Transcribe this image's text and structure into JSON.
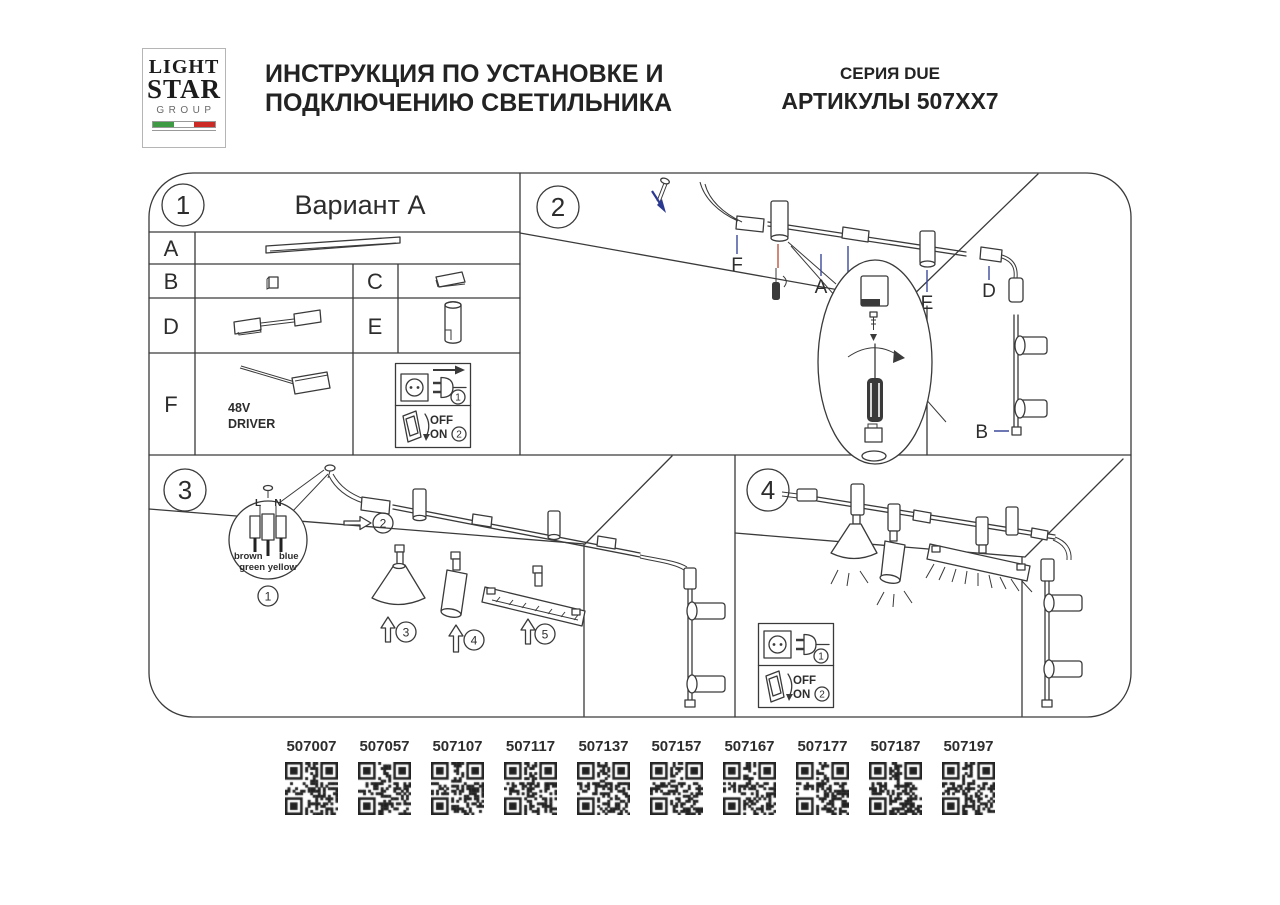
{
  "header": {
    "logo_line1": "LIGHT",
    "logo_line2": "STAR",
    "logo_line3": "GROUP",
    "title_line1": "ИНСТРУКЦИЯ ПО УСТАНОВКЕ И",
    "title_line2": "ПОДКЛЮЧЕНИЮ СВЕТИЛЬНИКА",
    "series": "СЕРИЯ DUE",
    "articles_title": "АРТИКУЛЫ 507XX7"
  },
  "panels": {
    "p1": {
      "num": "1",
      "variant_title": "Вариант А",
      "row_a": "A",
      "row_b": "B",
      "row_c": "C",
      "row_d": "D",
      "row_e": "E",
      "row_f": "F",
      "driver_line1": "48V",
      "driver_line2": "DRIVER",
      "power": {
        "step_unplug": "1",
        "step_switch": "2",
        "off": "OFF",
        "on": "ON"
      }
    },
    "p2": {
      "num": "2",
      "label_f": "F",
      "label_a": "A",
      "label_c": "C",
      "label_e": "E",
      "label_d": "D",
      "label_b": "B"
    },
    "p3": {
      "num": "3",
      "wire_l": "L",
      "wire_n": "N",
      "wire_brown": "brown",
      "wire_blue": "blue",
      "wire_green_yellow": "green yellow",
      "step1": "1",
      "step2": "2",
      "step3": "3",
      "step4": "4",
      "step5": "5"
    },
    "p4": {
      "num": "4",
      "power": {
        "step_plug": "1",
        "step_switch": "2",
        "off": "OFF",
        "on": "ON"
      }
    }
  },
  "articles": {
    "codes": [
      "507007",
      "507057",
      "507107",
      "507117",
      "507137",
      "507157",
      "507167",
      "507177",
      "507187",
      "507197"
    ]
  },
  "colors": {
    "ink": "#2d2d2d",
    "leader_blue": "#3b4a9b",
    "screw_arrow_blue": "#2b3990",
    "detail_red": "#c0543f",
    "flag_green": "#3f9b43",
    "flag_red": "#cc2a24"
  }
}
